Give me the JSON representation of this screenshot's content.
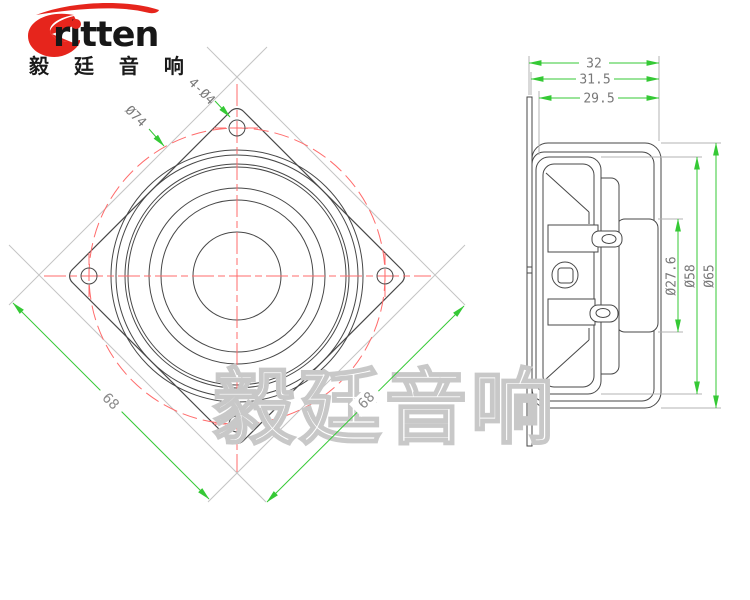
{
  "logo": {
    "brand": "ritten",
    "brand_cn": "毅 廷 音 响"
  },
  "watermark": {
    "text": "毅廷音响"
  },
  "front_view": {
    "hole_callout": "4-Ø4",
    "bolt_circle_dia": "Ø74",
    "side_dim_left": "68",
    "side_dim_right": "68"
  },
  "side_view": {
    "depth_total": "32",
    "depth_flange_back": "31.5",
    "depth_basket": "29.5",
    "magnet_dia": "Ø27.6",
    "cone_dia": "Ø58",
    "overall_dia": "Ø65"
  },
  "colors": {
    "dimension_green": "#35c935",
    "centerline_red": "#ff6b6b",
    "drawing_line": "#474747",
    "extension_gray": "#b3b3b3",
    "dim_text_gray": "#787878",
    "logo_red": "#e6251c",
    "watermark_gray": "#c8c8c8"
  }
}
